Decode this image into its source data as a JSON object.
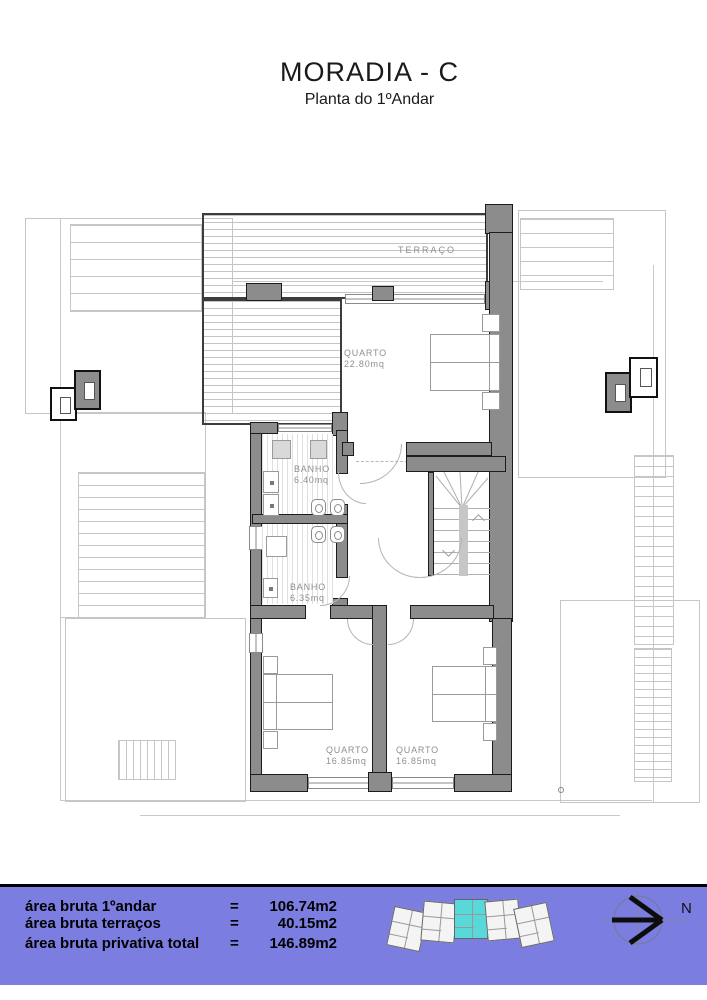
{
  "header": {
    "title": "MORADIA - C",
    "subtitle": "Planta do 1ºAndar"
  },
  "plan": {
    "rooms": {
      "terraco": {
        "name": "TERRAÇO"
      },
      "quarto_principal": {
        "name": "QUARTO",
        "area": "22.80mq"
      },
      "banho1": {
        "name": "BANHO",
        "area": "6.40mq"
      },
      "banho2": {
        "name": "BANHO",
        "area": "6.35mq"
      },
      "quarto2": {
        "name": "QUARTO",
        "area": "16.85mq"
      },
      "quarto3": {
        "name": "QUARTO",
        "area": "16.85mq"
      }
    }
  },
  "footer": {
    "rows": [
      {
        "label": "área bruta 1ºandar",
        "eq": "=",
        "value": "106.74m2"
      },
      {
        "label": "área bruta terraços",
        "eq": "=",
        "value": "40.15m2"
      },
      {
        "label": "área bruta privativa total",
        "eq": "=",
        "value": "146.89m2"
      }
    ],
    "compass": {
      "label": "N"
    },
    "colors": {
      "bar": "#7b7de0",
      "unit_highlight": "#58d8d8"
    }
  }
}
